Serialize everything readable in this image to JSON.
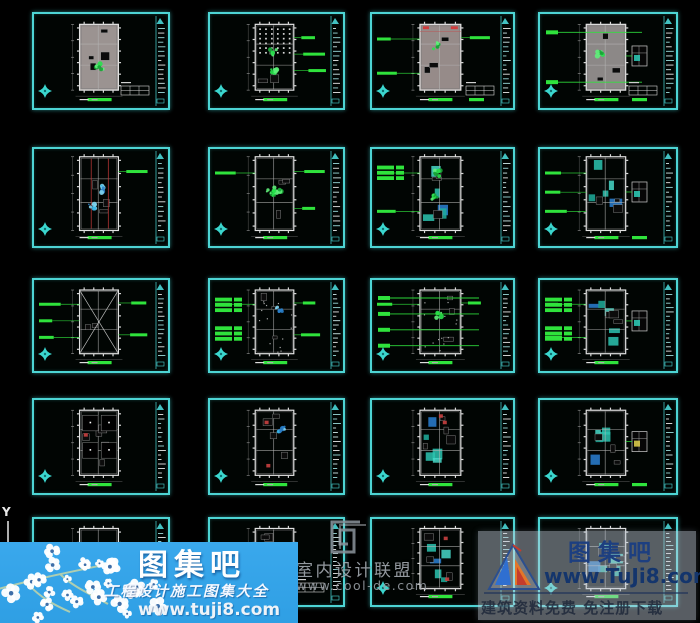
{
  "app": {
    "background": "#000000",
    "frame_border_color": "#4dd4d4",
    "annotation_green": "#2fe33c",
    "compass_cyan": "#3bd6ce"
  },
  "ucs": {
    "label": "Y"
  },
  "drawings": [
    {
      "id": "r1c1",
      "kind": "floor-plan",
      "fill": "#a8a09d",
      "furn": 5,
      "plant": 1,
      "table": true,
      "bars": 1
    },
    {
      "id": "r1c2",
      "kind": "ceiling-plan",
      "gridDots": true,
      "rightLabels": 3,
      "plant": 2,
      "bars": 1
    },
    {
      "id": "r1c3",
      "kind": "floor-plan",
      "fill": "#a39795",
      "redTop": true,
      "leftLabels": 2,
      "rightLabels": 1,
      "table": true,
      "bars": 2,
      "plant": 1
    },
    {
      "id": "r1c4",
      "kind": "floor-plan",
      "fill": "#989492",
      "leaders": 2,
      "detail": true,
      "table": true,
      "bars": 2,
      "plant": 1
    },
    {
      "id": "r2c1",
      "kind": "floor-plan",
      "plantBlue": 2,
      "redLines": true,
      "rightLabels": 1,
      "furn": 3,
      "bars": 1
    },
    {
      "id": "r2c2",
      "kind": "floor-plan",
      "plant": 3,
      "leftLabels": 1,
      "rightLabels": 2,
      "furn": 3,
      "bars": 1
    },
    {
      "id": "r2c3",
      "kind": "floor-plan",
      "teal": true,
      "leftBlocks": 1,
      "leftLabels": 2,
      "plant": 2,
      "furn": 3,
      "bars": 1
    },
    {
      "id": "r2c4",
      "kind": "floor-plan",
      "teal": true,
      "leftLabels": 3,
      "detail": true,
      "furn": 3,
      "bars": 2
    },
    {
      "id": "r3c1",
      "kind": "ceiling-plan",
      "diag": true,
      "leftLabels": 3,
      "rightLabels": 2,
      "furn": 2,
      "bars": 1
    },
    {
      "id": "r3c2",
      "kind": "floor-plan",
      "leftBlocks": 2,
      "leftLabels": 1,
      "rightLabels": 2,
      "plantBlue": 1,
      "dense": true,
      "bars": 1
    },
    {
      "id": "r3c3",
      "kind": "floor-plan",
      "leaders": 4,
      "leftLabels": 1,
      "rightLabels": 1,
      "plant": 1,
      "dense": true,
      "bars": 1
    },
    {
      "id": "r3c4",
      "kind": "floor-plan",
      "leftBlocks": 2,
      "leftLabels": 2,
      "detail": true,
      "teal": true,
      "bars": 1
    },
    {
      "id": "r4c1",
      "kind": "floor-plan",
      "furn": 6,
      "darkRooms": true,
      "redAcc": true,
      "bars": 1
    },
    {
      "id": "r4c2",
      "kind": "floor-plan",
      "plantBlue": 1,
      "redAcc": true,
      "furn": 4,
      "bars": 1
    },
    {
      "id": "r4c3",
      "kind": "floor-plan",
      "teal": true,
      "redAcc": true,
      "furn": 4,
      "bars": 1
    },
    {
      "id": "r4c4",
      "kind": "floor-plan",
      "teal": true,
      "detail": true,
      "detailYellow": true,
      "furn": 3,
      "bars": 2
    },
    {
      "id": "r5c1",
      "kind": "floor-plan",
      "furn": 4,
      "bars": 1
    },
    {
      "id": "r5c2",
      "kind": "floor-plan",
      "table": true,
      "furn": 4,
      "bars": 1
    },
    {
      "id": "r5c3",
      "kind": "floor-plan",
      "teal": true,
      "redAcc": true,
      "bars": 1
    },
    {
      "id": "r5c4",
      "kind": "floor-plan",
      "teal": true,
      "furn": 3,
      "bars": 1
    }
  ],
  "watermarks": {
    "left": {
      "title": "图集吧",
      "subtitle": "工程设计施工图集大全",
      "url": "www.tuji8.com",
      "bg_color": "#2f9fe4",
      "text_color": "#ffffff"
    },
    "center": {
      "title": "室内设计联盟",
      "url": "www.cool-de.com",
      "color": "#a8aeb5"
    },
    "right": {
      "title": "图集吧",
      "url": "www.TuJi8.com",
      "tagline": "建筑资料免费  免注册下载",
      "text_color": "#1d3f80"
    }
  }
}
